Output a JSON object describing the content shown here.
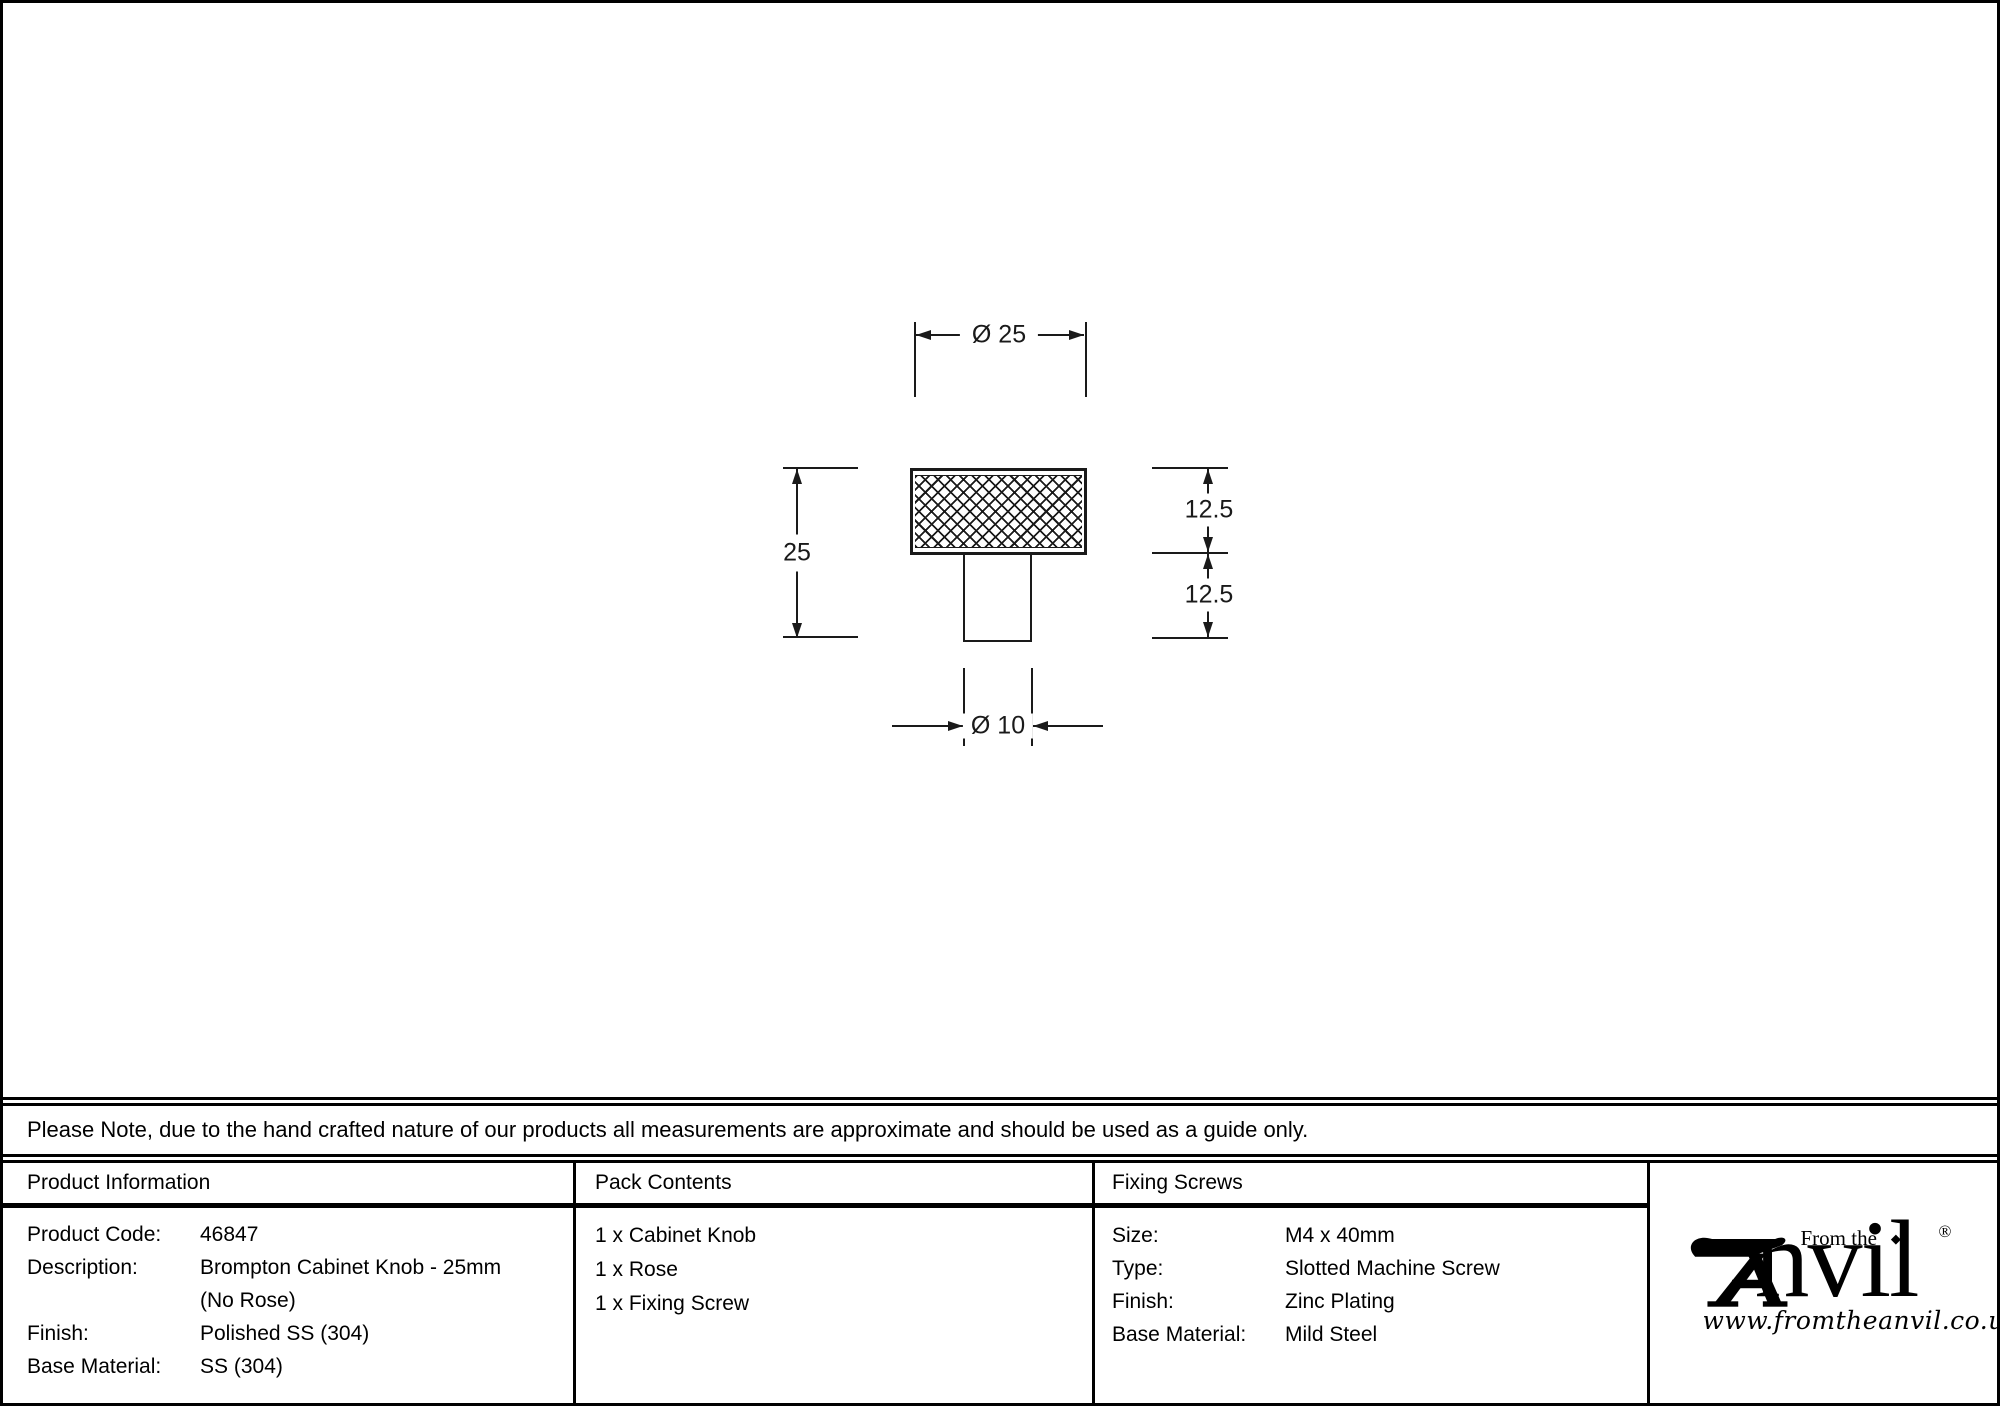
{
  "note": "Please Note, due to the hand crafted nature of our products all measurements are approximate and should be used as a guide only.",
  "drawing": {
    "dim_top_diameter": "Ø 25",
    "dim_left_height": "25",
    "dim_right_upper": "12.5",
    "dim_right_lower": "12.5",
    "dim_bottom_diameter": "Ø 10"
  },
  "product_info": {
    "header": "Product Information",
    "rows": [
      {
        "label": "Product Code:",
        "value": "46847"
      },
      {
        "label": "Description:",
        "value": "Brompton Cabinet Knob - 25mm",
        "value2": "(No Rose)"
      },
      {
        "label": "Finish:",
        "value": "Polished SS (304)"
      },
      {
        "label": "Base Material:",
        "value": "SS (304)"
      }
    ]
  },
  "pack_contents": {
    "header": "Pack Contents",
    "items": [
      "1 x Cabinet Knob",
      "1 x Rose",
      "1 x Fixing Screw"
    ]
  },
  "fixing_screws": {
    "header": "Fixing Screws",
    "rows": [
      {
        "label": "Size:",
        "value": "M4 x 40mm"
      },
      {
        "label": "Type:",
        "value": "Slotted Machine Screw"
      },
      {
        "label": "Finish:",
        "value": "Zinc Plating"
      },
      {
        "label": "Base Material:",
        "value": "Mild Steel"
      }
    ]
  },
  "logo": {
    "from_the": "From the",
    "diamond": "◆",
    "wordmark_rest": "nvil",
    "registered": "®",
    "url": "www.fromtheanvil.co.uk"
  },
  "colors": {
    "line": "#1a1a1a",
    "border": "#000000",
    "background": "#ffffff"
  }
}
